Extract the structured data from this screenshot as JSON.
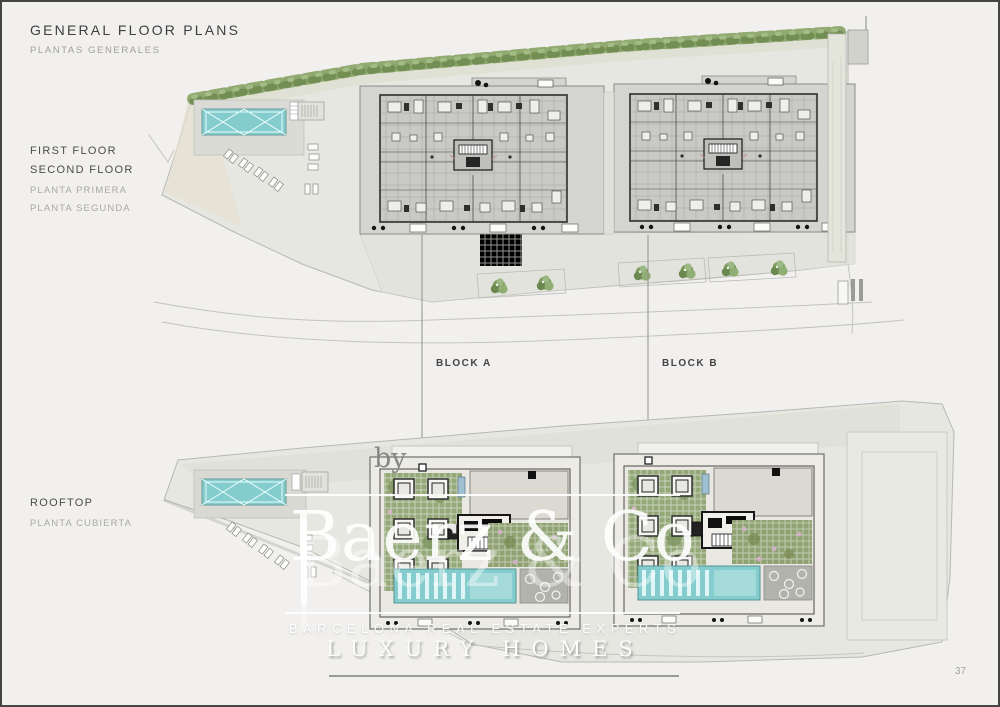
{
  "page": {
    "title": "GENERAL FLOOR PLANS",
    "subtitle": "PLANTAS GENERALES",
    "page_number": "37"
  },
  "plan_labels": {
    "upper": {
      "en1": "FIRST FLOOR",
      "en2": "SECOND FLOOR",
      "es1": "PLANTA PRIMERA",
      "es2": "PLANTA SEGUNDA"
    },
    "lower": {
      "en1": "ROOFTOP",
      "es1": "PLANTA CUBIERTA"
    }
  },
  "blocks": [
    {
      "label": "BLOCK A"
    },
    {
      "label": "BLOCK B"
    }
  ],
  "watermark": {
    "by": "by",
    "brand": "Baerz & Co",
    "line1": "BARCELONA REAL ESTATE EXPERTS",
    "line2": "LUXURY HOMES"
  },
  "colors": {
    "pool": "#84cccd",
    "garden": "#94a878",
    "garden2": "#8ea272",
    "site": "#e6e7e1",
    "building": "#c9c9c6",
    "roof_slab": "#dcd9d2"
  }
}
